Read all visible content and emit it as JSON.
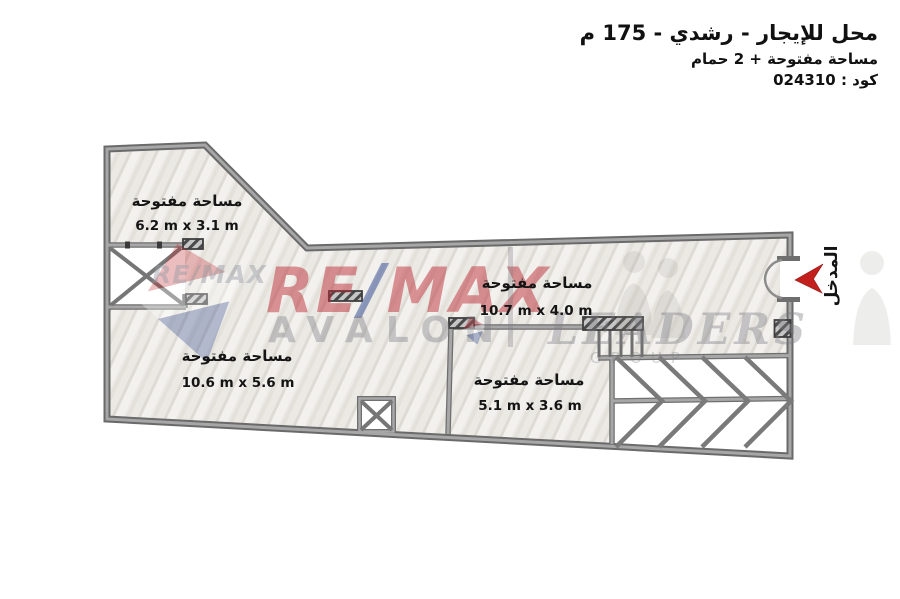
{
  "header": {
    "title": "محل للإيجار - رشدي - 175 م",
    "subtitle": "مساحة مفتوحة + 2 حمام",
    "code": "كود : 024310"
  },
  "rooms": [
    {
      "name": "مساحة مفتوحة",
      "dims": "6.2 m x 3.1 m"
    },
    {
      "name": "مساحة مفتوحة",
      "dims": "10.7 m x 4.0 m"
    },
    {
      "name": "مساحة مفتوحة",
      "dims": "10.6 m x 5.6 m"
    },
    {
      "name": "مساحة مفتوحة",
      "dims": "5.1 m x 3.6 m"
    }
  ],
  "entrance_label": "المدخل",
  "watermark": {
    "re": "RE",
    "slash": "/",
    "max": "MAX",
    "avalon": "AVALON",
    "leaders": "LEADERS",
    "group": "GROUP",
    "re_small": "RE/MAX"
  },
  "colors": {
    "wall": "#6a6a6a",
    "wall_light": "#a7a7a7",
    "floor": "#eceae6",
    "arrow_red": "#c3201d",
    "remax_red": "#ba2630",
    "remax_blue": "#234091"
  }
}
